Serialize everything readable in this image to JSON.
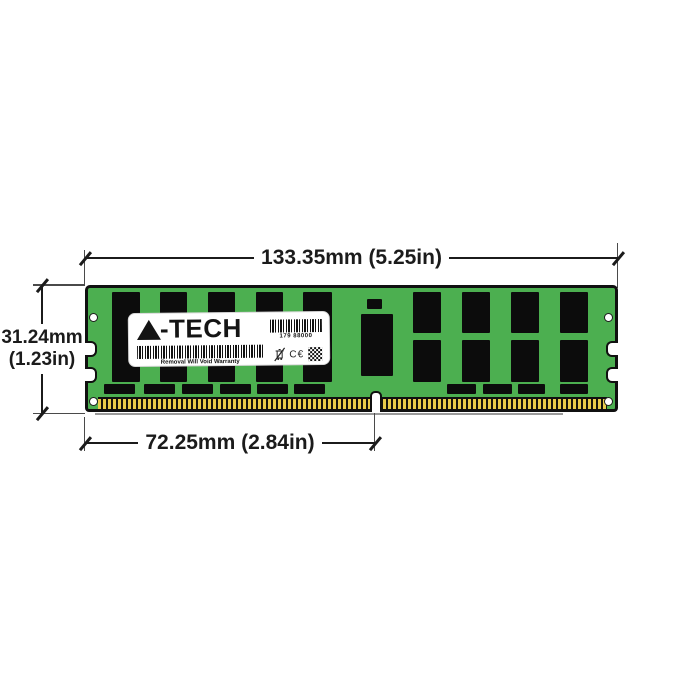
{
  "title": "A-Tech memory module dimension diagram",
  "dimensions": {
    "width": "133.35mm (5.25in)",
    "height_mm": "31.24mm",
    "height_in": "(1.23in)",
    "pin_span": "72.25mm (2.84in)"
  },
  "label": {
    "brand": "A-TECH",
    "brand_suffix": "-TECH",
    "serial": "179 88000",
    "warranty": "Removal Will Void Warranty",
    "ce": "C€"
  },
  "colors": {
    "pcb": "#4caf50",
    "chip": "#0c0c0c",
    "gold": "#e8cb4a",
    "outline": "#101010",
    "dimension": "#1b1b1b"
  },
  "module": {
    "chips": [
      [
        24,
        4,
        28,
        90
      ],
      [
        72,
        4,
        27,
        90
      ],
      [
        120,
        4,
        27,
        90
      ],
      [
        168,
        4,
        27,
        90
      ],
      [
        215,
        4,
        29,
        90
      ],
      [
        279,
        11,
        15,
        10
      ],
      [
        273,
        26,
        32,
        62
      ],
      [
        325,
        4,
        28,
        41
      ],
      [
        374,
        4,
        28,
        41
      ],
      [
        423,
        4,
        28,
        41
      ],
      [
        472,
        4,
        28,
        41
      ],
      [
        325,
        52,
        28,
        42
      ],
      [
        374,
        52,
        28,
        42
      ],
      [
        423,
        52,
        28,
        42
      ],
      [
        472,
        52,
        28,
        42
      ],
      [
        16,
        96,
        31,
        10
      ],
      [
        56,
        96,
        31,
        10
      ],
      [
        94,
        96,
        31,
        10
      ],
      [
        132,
        96,
        31,
        10
      ],
      [
        169,
        96,
        31,
        10
      ],
      [
        206,
        96,
        31,
        10
      ],
      [
        359,
        96,
        29,
        10
      ],
      [
        395,
        96,
        29,
        10
      ],
      [
        430,
        96,
        27,
        10
      ],
      [
        472,
        96,
        28,
        10
      ]
    ],
    "screw_holes": [
      [
        1,
        25
      ],
      [
        1,
        109
      ],
      [
        516,
        25
      ],
      [
        516,
        109
      ]
    ],
    "notches_left": [
      53,
      79
    ],
    "notches_right": [
      53,
      79
    ]
  }
}
